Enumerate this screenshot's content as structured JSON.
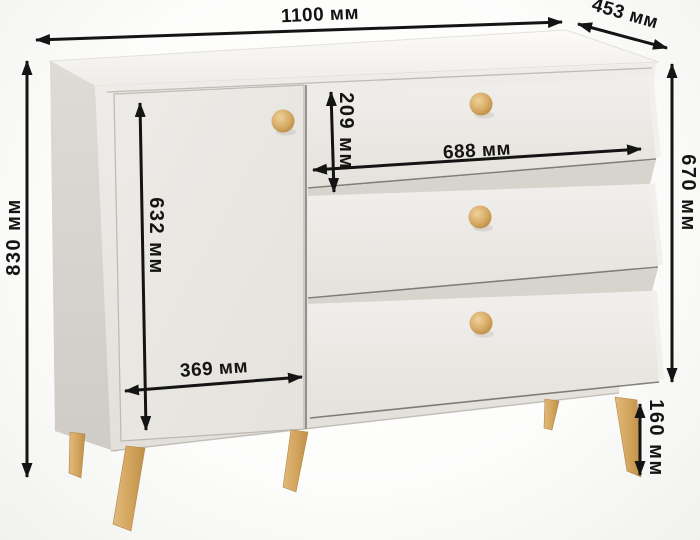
{
  "diagram": {
    "product": "dresser-with-door-and-three-drawers",
    "unit": "мм",
    "dimensions": {
      "overall_width": {
        "value": 1100,
        "label": "1100 мм"
      },
      "overall_depth": {
        "value": 453,
        "label": "453 мм"
      },
      "overall_height": {
        "value": 830,
        "label": "830 мм"
      },
      "body_height": {
        "value": 670,
        "label": "670 мм"
      },
      "drawer_front_height": {
        "value": 209,
        "label": "209 мм"
      },
      "drawer_width": {
        "value": 688,
        "label": "688 мм"
      },
      "door_height": {
        "value": 632,
        "label": "632 мм"
      },
      "door_width": {
        "value": 369,
        "label": "369 мм"
      },
      "leg_height": {
        "value": 160,
        "label": "160 мм"
      }
    },
    "structure": {
      "doors": 1,
      "drawers": 3,
      "knobs": 4,
      "legs_visible": 5
    },
    "colors": {
      "arrow": "#141414",
      "cabinet_front": "#eae7e2",
      "cabinet_side": "#d6d2cd",
      "cabinet_top": "#f6f4f1",
      "wood": "#d2a45c",
      "background": "#fbfbfa"
    }
  }
}
